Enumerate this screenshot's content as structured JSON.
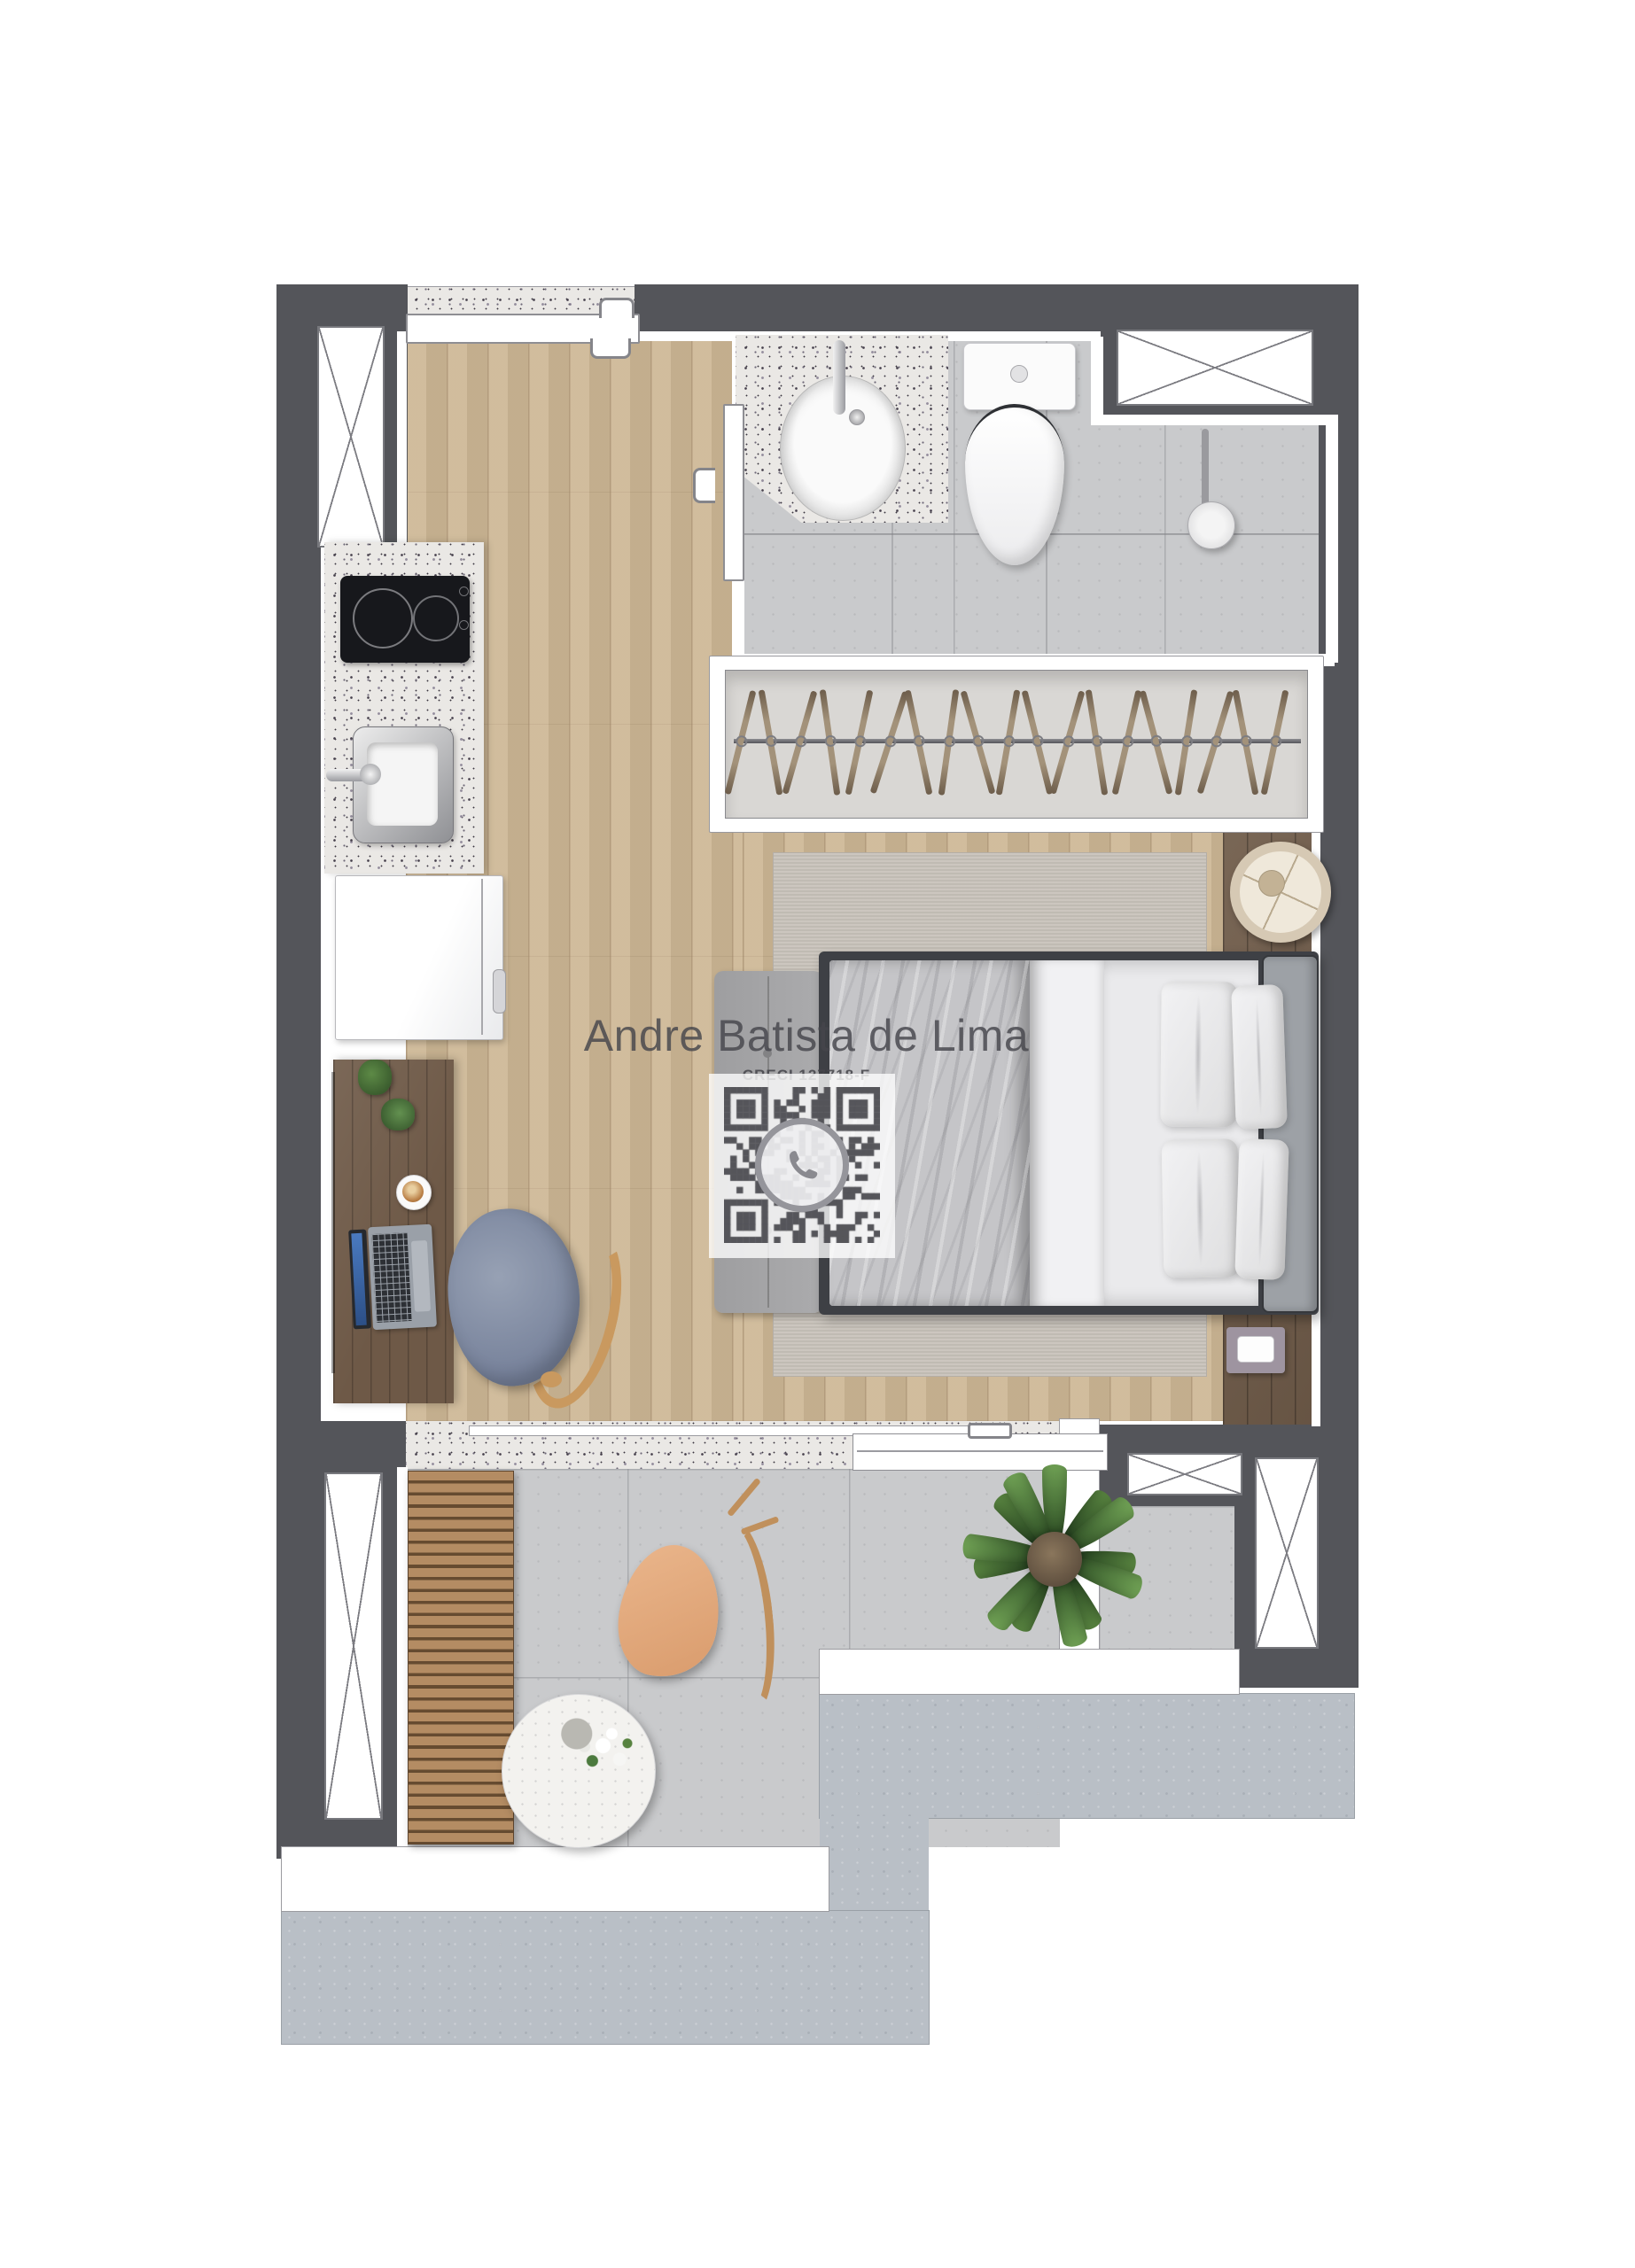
{
  "watermark": {
    "name": "Andre Batista de Lima",
    "creci": "CRECI 127718-F"
  },
  "qr": {
    "label": "whatsapp-contact-qr",
    "icon": "whatsapp-icon",
    "modules": 25,
    "seed": 73
  },
  "closet": {
    "hanger_count": 19
  },
  "plant": {
    "leaf_count": 13
  },
  "colors": {
    "wall_dark": "#54555a",
    "outline": "#77787d",
    "wood_floor": "#cdb795",
    "desk_wood": "#6e5947",
    "walnut_floor": "#6f5b49",
    "granite_base": "#eae8e5",
    "tile_bath": "#c9cacc",
    "concrete": "#b9bfc6",
    "rug": "#c9c3bb",
    "bed_frame": "#3e4045",
    "headboard": "#9da1a6",
    "duvet": "#c5c5c8",
    "sheet": "#f1f1f3",
    "ottoman": "#a4a4a6",
    "closet_interior": "#d9d7d4",
    "hanger": "#a3927a",
    "chair_fabric": "#8792a6",
    "chair_wood": "#c9995f",
    "balcony_chair": "#e3a87e",
    "slat_wood": "#b48c63",
    "slat_gap": "#664b30",
    "plant_green": "#4c7a3e",
    "qr_dark": "#4b4b50",
    "watermark": "#46464c"
  }
}
